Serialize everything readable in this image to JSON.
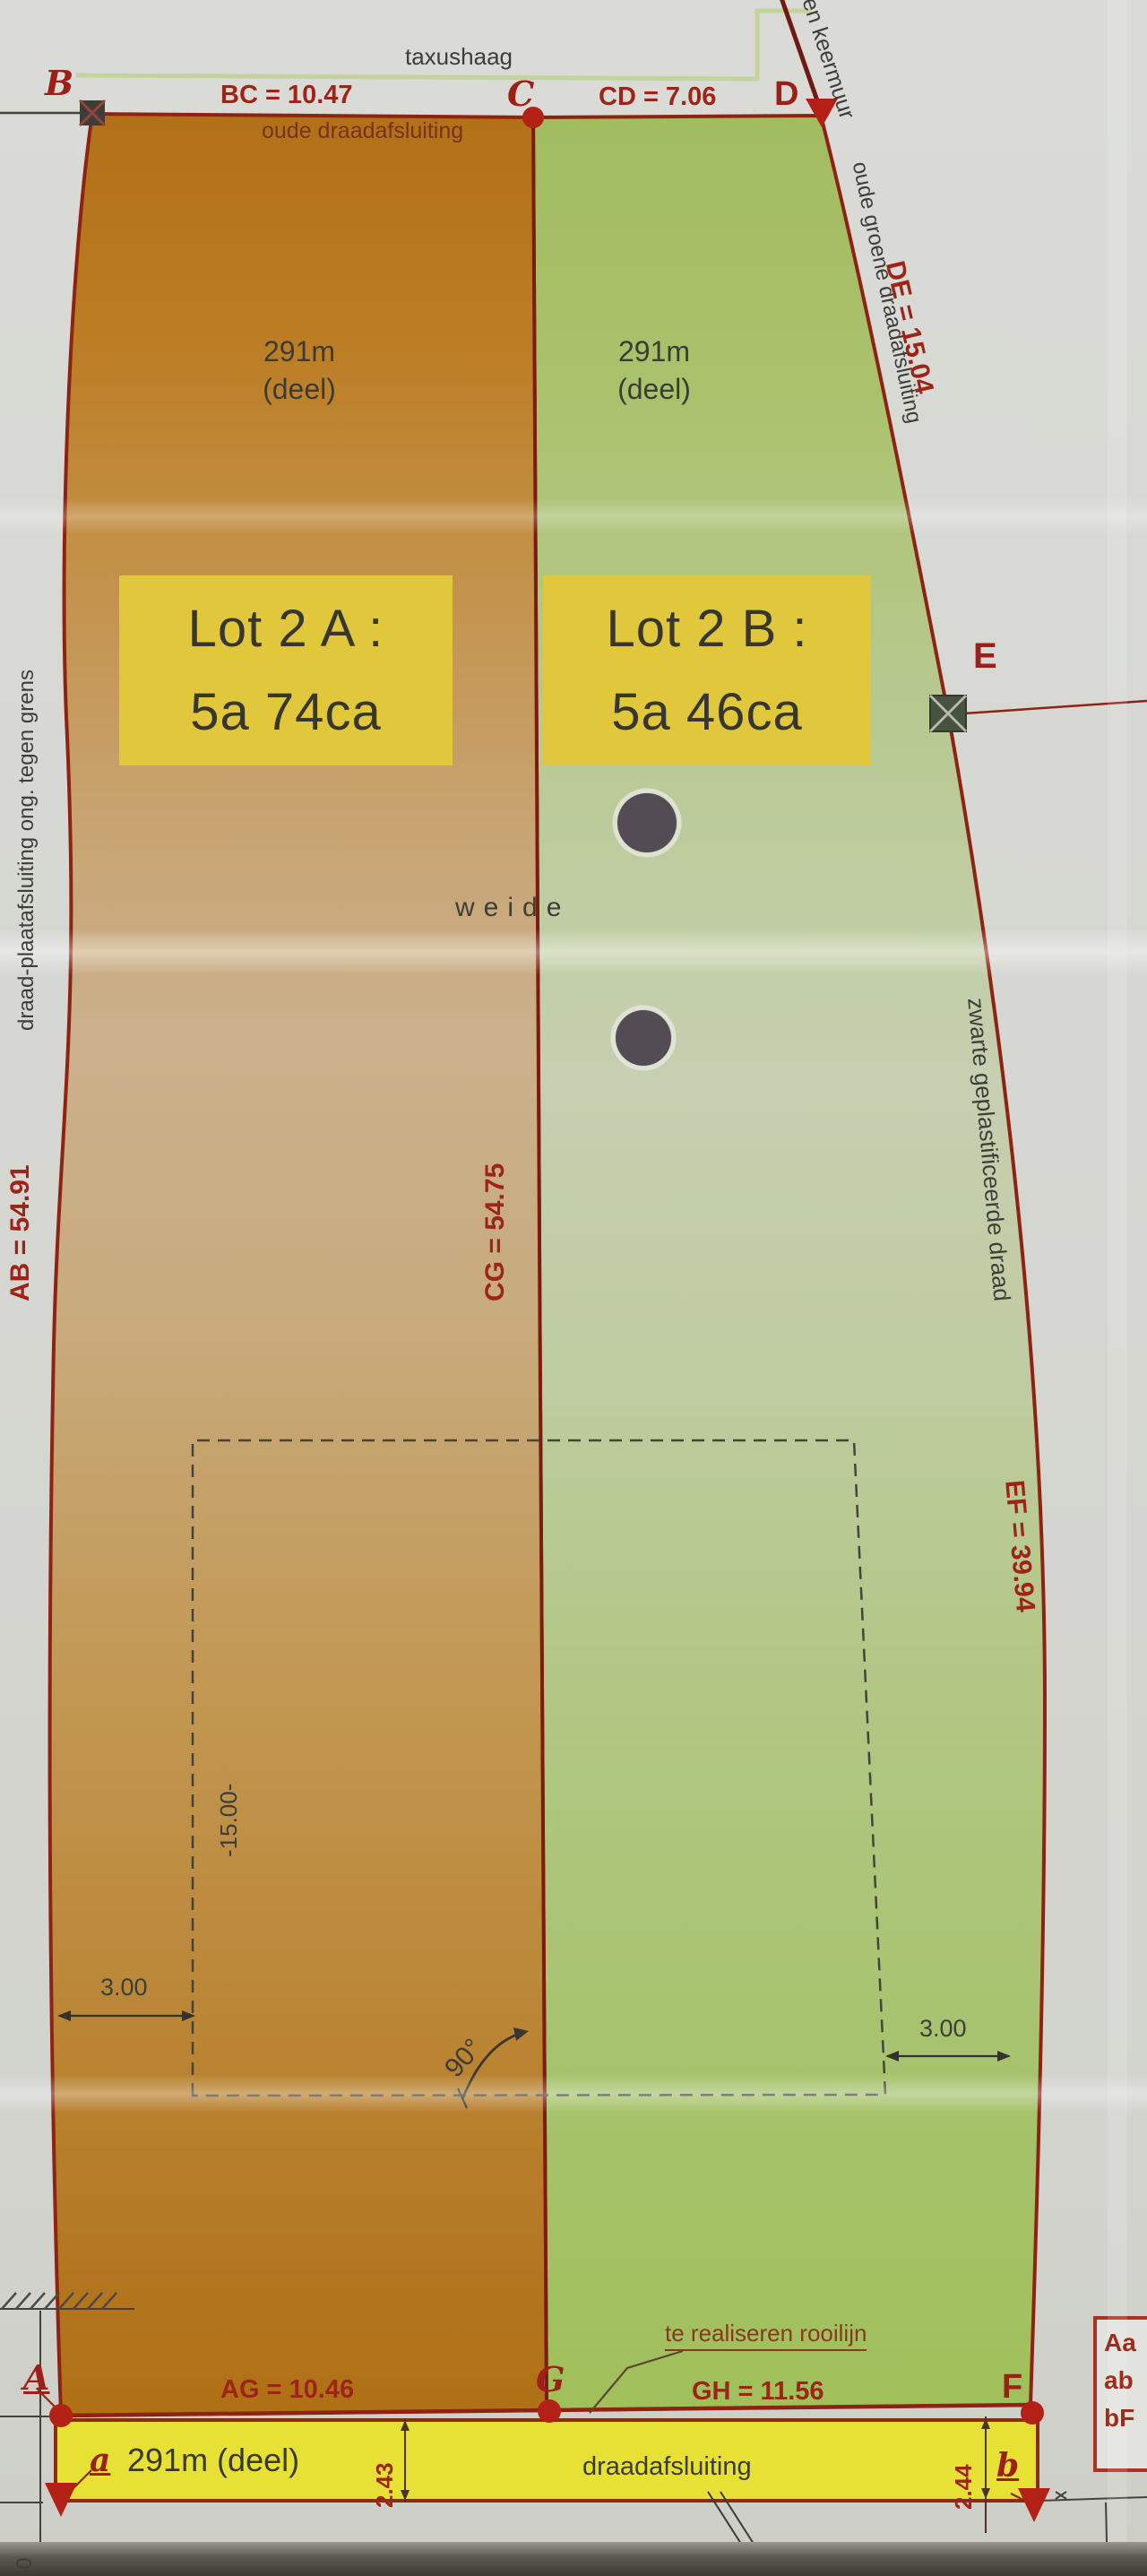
{
  "points": {
    "b": "B",
    "c": "C",
    "d": "D",
    "e": "E",
    "f": "F",
    "g": "G",
    "a": "A",
    "a_lower": "a",
    "b_lower": "b"
  },
  "dimensions": {
    "bc": "BC = 10.47",
    "cd": "CD = 7.06",
    "de": "DE = 15.04",
    "ab": "AB = 54.91",
    "cg": "CG = 54.75",
    "ef": "EF = 39.94",
    "ag": "AG = 10.46",
    "gh": "GH = 11.56",
    "strip_left": "2.43",
    "strip_right": "2.44",
    "offset_left": "3.00",
    "offset_right": "3.00",
    "depth": "-15.00-",
    "angle": "90°",
    "margin": "50"
  },
  "annotations": {
    "hedge": "taxushaag",
    "old_fence": "oude draadafsluiting",
    "retaining_wall": "en keermuur",
    "old_green_fence": "oude groene draadafsluiting",
    "left_fence": "draad-plaatafsluiting ong. tegen grens",
    "black_wire": "zwarte geplastificeerde draad",
    "meadow": "weide",
    "building_line": "te realiseren rooilijn",
    "fence": "draadafsluiting"
  },
  "lots": {
    "a": {
      "area": "291m",
      "deel": "(deel)",
      "name": "Lot 2 A :",
      "size": "5a 74ca"
    },
    "b": {
      "area": "291m",
      "deel": "(deel)",
      "name": "Lot 2 B :",
      "size": "5a 46ca"
    }
  },
  "strip": {
    "label": "291m (deel)"
  },
  "legend": {
    "items": [
      "Aa",
      "ab",
      "bF"
    ]
  },
  "colors": {
    "lot_a_orange": "#b4741a",
    "lot_b_green": "#a4bd61",
    "highlight_yellow": "#e1c73c",
    "strip_yellow": "#e6e134",
    "boundary_red": "#8e2213",
    "dim_text_red": "#9e2417",
    "ink_dark": "#3e3e39",
    "paper_gray": "#d6d7d2"
  }
}
